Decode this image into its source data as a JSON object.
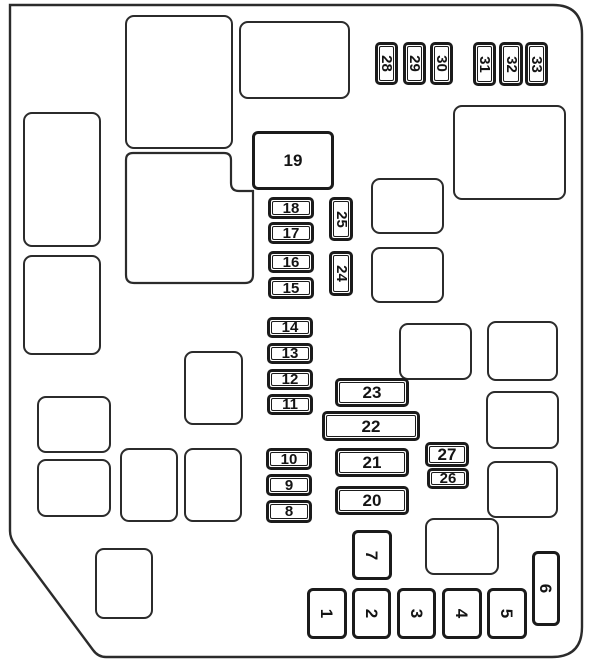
{
  "diagram": {
    "title": "Engine compartment fuse box diagram",
    "line_color": "#1b1b1b",
    "background_color": "#ffffff",
    "fuses": [
      {
        "label": "1",
        "x": 307,
        "y": 588,
        "w": 40,
        "h": 51,
        "orient": "v",
        "style": "single"
      },
      {
        "label": "2",
        "x": 352,
        "y": 588,
        "w": 39,
        "h": 51,
        "orient": "v",
        "style": "single"
      },
      {
        "label": "3",
        "x": 397,
        "y": 588,
        "w": 39,
        "h": 51,
        "orient": "v",
        "style": "single"
      },
      {
        "label": "4",
        "x": 442,
        "y": 588,
        "w": 40,
        "h": 51,
        "orient": "v",
        "style": "single"
      },
      {
        "label": "5",
        "x": 487,
        "y": 588,
        "w": 40,
        "h": 51,
        "orient": "v",
        "style": "single"
      },
      {
        "label": "6",
        "x": 532,
        "y": 551,
        "w": 28,
        "h": 75,
        "orient": "v",
        "style": "single"
      },
      {
        "label": "7",
        "x": 352,
        "y": 530,
        "w": 40,
        "h": 50,
        "orient": "v",
        "style": "single"
      },
      {
        "label": "8",
        "x": 266,
        "y": 500,
        "w": 46,
        "h": 23,
        "orient": "h",
        "style": "double"
      },
      {
        "label": "9",
        "x": 266,
        "y": 474,
        "w": 46,
        "h": 22,
        "orient": "h",
        "style": "double"
      },
      {
        "label": "10",
        "x": 266,
        "y": 448,
        "w": 46,
        "h": 22,
        "orient": "h",
        "style": "double"
      },
      {
        "label": "11",
        "x": 267,
        "y": 394,
        "w": 46,
        "h": 21,
        "orient": "h",
        "style": "double"
      },
      {
        "label": "12",
        "x": 267,
        "y": 369,
        "w": 46,
        "h": 21,
        "orient": "h",
        "style": "double"
      },
      {
        "label": "13",
        "x": 267,
        "y": 343,
        "w": 46,
        "h": 21,
        "orient": "h",
        "style": "double"
      },
      {
        "label": "14",
        "x": 267,
        "y": 317,
        "w": 46,
        "h": 21,
        "orient": "h",
        "style": "double"
      },
      {
        "label": "15",
        "x": 268,
        "y": 277,
        "w": 46,
        "h": 22,
        "orient": "h",
        "style": "double"
      },
      {
        "label": "16",
        "x": 268,
        "y": 251,
        "w": 46,
        "h": 22,
        "orient": "h",
        "style": "double"
      },
      {
        "label": "17",
        "x": 268,
        "y": 222,
        "w": 46,
        "h": 22,
        "orient": "h",
        "style": "double"
      },
      {
        "label": "18",
        "x": 268,
        "y": 197,
        "w": 46,
        "h": 22,
        "orient": "h",
        "style": "double"
      },
      {
        "label": "19",
        "x": 252,
        "y": 131,
        "w": 82,
        "h": 59,
        "orient": "h",
        "style": "single"
      },
      {
        "label": "20",
        "x": 335,
        "y": 486,
        "w": 74,
        "h": 29,
        "orient": "h",
        "style": "double"
      },
      {
        "label": "21",
        "x": 335,
        "y": 448,
        "w": 74,
        "h": 29,
        "orient": "h",
        "style": "double"
      },
      {
        "label": "22",
        "x": 322,
        "y": 411,
        "w": 98,
        "h": 30,
        "orient": "h",
        "style": "double"
      },
      {
        "label": "23",
        "x": 335,
        "y": 378,
        "w": 74,
        "h": 29,
        "orient": "h",
        "style": "double"
      },
      {
        "label": "24",
        "x": 329,
        "y": 251,
        "w": 24,
        "h": 45,
        "orient": "v",
        "style": "double"
      },
      {
        "label": "25",
        "x": 329,
        "y": 197,
        "w": 24,
        "h": 44,
        "orient": "v",
        "style": "double"
      },
      {
        "label": "26",
        "x": 427,
        "y": 468,
        "w": 42,
        "h": 21,
        "orient": "h",
        "style": "double"
      },
      {
        "label": "27",
        "x": 425,
        "y": 442,
        "w": 44,
        "h": 25,
        "orient": "h",
        "style": "double"
      },
      {
        "label": "28",
        "x": 375,
        "y": 42,
        "w": 23,
        "h": 43,
        "orient": "v",
        "style": "double"
      },
      {
        "label": "29",
        "x": 403,
        "y": 42,
        "w": 23,
        "h": 43,
        "orient": "v",
        "style": "double"
      },
      {
        "label": "30",
        "x": 430,
        "y": 42,
        "w": 23,
        "h": 43,
        "orient": "v",
        "style": "double"
      },
      {
        "label": "31",
        "x": 473,
        "y": 42,
        "w": 23,
        "h": 44,
        "orient": "v",
        "style": "double"
      },
      {
        "label": "32",
        "x": 499,
        "y": 42,
        "w": 24,
        "h": 44,
        "orient": "v",
        "style": "double"
      },
      {
        "label": "33",
        "x": 525,
        "y": 42,
        "w": 23,
        "h": 44,
        "orient": "v",
        "style": "double"
      }
    ],
    "slots": [
      {
        "name": "slot-top-center-large",
        "x": 125,
        "y": 15,
        "w": 108,
        "h": 134
      },
      {
        "name": "slot-top-right",
        "x": 239,
        "y": 21,
        "w": 111,
        "h": 78
      },
      {
        "name": "slot-right-upper",
        "x": 453,
        "y": 105,
        "w": 113,
        "h": 95
      },
      {
        "name": "slot-left-tall",
        "x": 23,
        "y": 112,
        "w": 78,
        "h": 135
      },
      {
        "name": "slot-left-mid",
        "x": 23,
        "y": 255,
        "w": 78,
        "h": 100
      },
      {
        "name": "slot-mid-right-a",
        "x": 371,
        "y": 178,
        "w": 73,
        "h": 56
      },
      {
        "name": "slot-mid-right-b",
        "x": 371,
        "y": 247,
        "w": 73,
        "h": 56
      },
      {
        "name": "slot-center-small",
        "x": 184,
        "y": 351,
        "w": 59,
        "h": 74
      },
      {
        "name": "slot-center-right",
        "x": 399,
        "y": 323,
        "w": 73,
        "h": 57
      },
      {
        "name": "slot-right-col-1",
        "x": 487,
        "y": 321,
        "w": 71,
        "h": 60
      },
      {
        "name": "slot-right-col-2",
        "x": 486,
        "y": 391,
        "w": 73,
        "h": 58
      },
      {
        "name": "slot-right-col-3",
        "x": 487,
        "y": 461,
        "w": 71,
        "h": 57
      },
      {
        "name": "slot-left-lower-1",
        "x": 37,
        "y": 396,
        "w": 74,
        "h": 57
      },
      {
        "name": "slot-left-lower-2",
        "x": 37,
        "y": 459,
        "w": 74,
        "h": 58
      },
      {
        "name": "slot-bottom-mid-1",
        "x": 120,
        "y": 448,
        "w": 58,
        "h": 74
      },
      {
        "name": "slot-bottom-mid-2",
        "x": 184,
        "y": 448,
        "w": 58,
        "h": 74
      },
      {
        "name": "slot-bottom-left-small",
        "x": 95,
        "y": 548,
        "w": 58,
        "h": 71
      },
      {
        "name": "slot-bottom-center",
        "x": 425,
        "y": 518,
        "w": 74,
        "h": 57
      }
    ]
  }
}
